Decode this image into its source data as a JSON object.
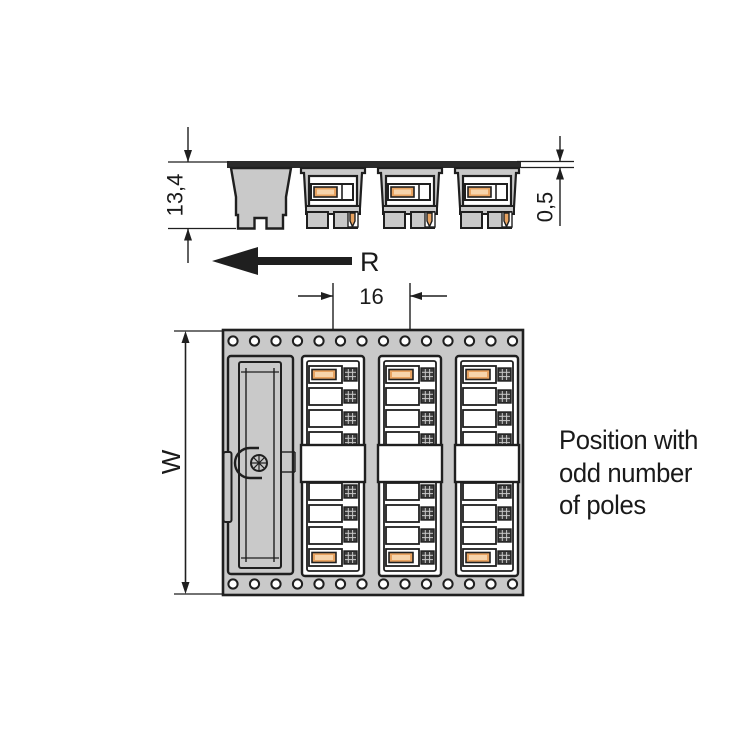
{
  "drawing": {
    "labels": {
      "height": "13,4",
      "tape_thickness": "0,5",
      "unreeling_direction": "R",
      "pitch": "16",
      "tape_width": "W"
    },
    "annotation": {
      "line1": "Position with",
      "line2": "odd number",
      "line3": "of poles"
    },
    "colors": {
      "outline": "#1f1f1f",
      "tape_gray": "#c9c9c9",
      "carrier_dark": "#2b2b2b",
      "contact_orange": "#e8a361",
      "contact_orange_light": "#f7d4ab",
      "pocket_white": "#ffffff",
      "text": "#1a1a1a",
      "background": "#ffffff"
    }
  }
}
